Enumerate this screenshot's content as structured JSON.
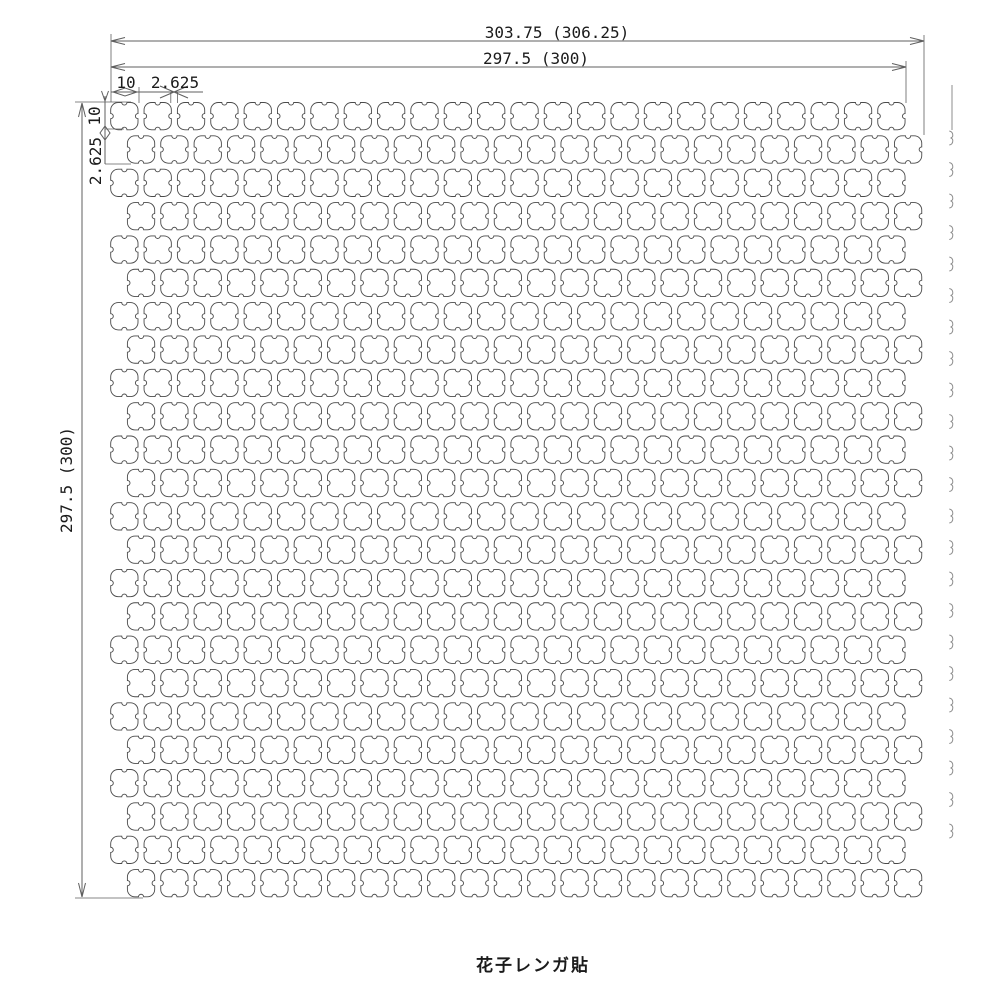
{
  "drawing": {
    "caption": "花子レンガ貼",
    "dims": {
      "top_outer": "303.75 (306.25)",
      "top_inner": "297.5 (300)",
      "left_outer": "297.5 (300)",
      "top_tile_width": "10",
      "top_joint_width": "2.625",
      "left_tile_height": "10",
      "left_joint_height": "2.625"
    },
    "colors": {
      "background": "#ffffff",
      "tile_line": "#4a4a4a",
      "dimension_line": "#5f5f5f",
      "fragment_line": "#8d8d8d",
      "text": "#1b1b1b"
    },
    "pattern": {
      "rows": 24,
      "columns": 24,
      "tile_px": 27.3,
      "pitch_px": 33.35,
      "origin_x": 110.7,
      "origin_y": 102.5,
      "offset_shift_px": 16.7,
      "tile_mm": "10",
      "joint_mm": "2.625",
      "bond": "running-bond-half-offset"
    },
    "next_sheet_marks": {
      "x": 948.5,
      "y_start": 131,
      "pitch": 31.5,
      "count": 23
    }
  }
}
